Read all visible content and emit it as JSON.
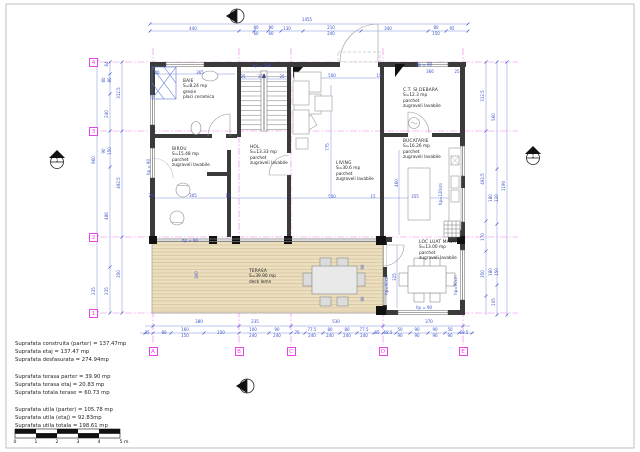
{
  "drawing": {
    "section_marks": {
      "left_label": "1",
      "right_label": "1"
    },
    "grid": {
      "cols": [
        {
          "t": "A",
          "x": 153
        },
        {
          "t": "B",
          "x": 239
        },
        {
          "t": "C",
          "x": 291
        },
        {
          "t": "D",
          "x": 383
        },
        {
          "t": "E",
          "x": 463
        }
      ],
      "rows": [
        {
          "t": "4",
          "y": 62
        },
        {
          "t": "3",
          "y": 131
        },
        {
          "t": "2",
          "y": 237
        },
        {
          "t": "1",
          "y": 313
        }
      ]
    },
    "rooms": [
      {
        "id": "baie",
        "x": 183,
        "y": 79,
        "lines": [
          "BAIE",
          "S=8.24 mp",
          "gresie",
          "placi ceramica"
        ]
      },
      {
        "id": "birou",
        "x": 172,
        "y": 147,
        "lines": [
          "BIROU",
          "S=15.48 mp",
          "parchet",
          "zugraveli lavabile"
        ]
      },
      {
        "id": "hol",
        "x": 250,
        "y": 145,
        "lines": [
          "HOL",
          "S=13.33 mp",
          "parchet",
          "zugraveli lavabile"
        ]
      },
      {
        "id": "living",
        "x": 336,
        "y": 161,
        "lines": [
          "LIVING",
          "S=30.6 mp",
          "parchet",
          "zugraveli lavabile"
        ]
      },
      {
        "id": "ct-debara",
        "x": 403,
        "y": 88,
        "lines": [
          "C.T. SI DEBARA",
          "S=12.3 mp",
          "parchet",
          "zugraveli lavabile"
        ]
      },
      {
        "id": "bucatarie",
        "x": 403,
        "y": 139,
        "lines": [
          "BUCATARIE",
          "S=16.26 mp",
          "parchet",
          "zugraveli lavabile"
        ]
      },
      {
        "id": "loc-luat-masa",
        "x": 419,
        "y": 240,
        "lines": [
          "LOC LUAT MASA",
          "S=13.00 mp",
          "parchet",
          "zugraveli lavabile"
        ]
      },
      {
        "id": "terasa",
        "x": 249,
        "y": 269,
        "lines": [
          "TERASA",
          "S=39.90 mp",
          "deck lemn"
        ]
      }
    ],
    "hp_labels": [
      {
        "t": "hp = 180",
        "x": 262,
        "y": 66
      },
      {
        "t": "hp = 90",
        "x": 424,
        "y": 65
      },
      {
        "t": "hp = 90",
        "x": 190,
        "y": 241
      },
      {
        "t": "hp = 90",
        "x": 424,
        "y": 308
      },
      {
        "t": "hp = 90",
        "x": 149,
        "y": 167,
        "v": true
      },
      {
        "t": "hp=120cm",
        "x": 441,
        "y": 194,
        "v": true
      },
      {
        "t": "hp=90cm",
        "x": 387,
        "y": 285,
        "v": true
      },
      {
        "t": "hp=90cm",
        "x": 456,
        "y": 285,
        "v": true
      }
    ],
    "dims": [
      {
        "t": "1455",
        "x": 307,
        "y": 20
      },
      {
        "t": "440",
        "x": 193,
        "y": 29
      },
      {
        "t": "80",
        "x": 256,
        "y": 27.5
      },
      {
        "t": "60",
        "x": 256,
        "y": 33.5
      },
      {
        "t": "80",
        "x": 271,
        "y": 27.5
      },
      {
        "t": "60",
        "x": 271,
        "y": 33.5
      },
      {
        "t": "130",
        "x": 287,
        "y": 29
      },
      {
        "t": "210",
        "x": 331,
        "y": 27.5
      },
      {
        "t": "240",
        "x": 331,
        "y": 33.5
      },
      {
        "t": "340",
        "x": 388,
        "y": 29
      },
      {
        "t": "80",
        "x": 436,
        "y": 27.5
      },
      {
        "t": "150",
        "x": 436,
        "y": 33.5
      },
      {
        "t": "95",
        "x": 452,
        "y": 29
      },
      {
        "t": "380",
        "x": 199,
        "y": 322
      },
      {
        "t": "235",
        "x": 255,
        "y": 322
      },
      {
        "t": "530",
        "x": 336,
        "y": 322
      },
      {
        "t": "370",
        "x": 429,
        "y": 322
      },
      {
        "t": "35",
        "x": 147,
        "y": 333
      },
      {
        "t": "80",
        "x": 164,
        "y": 333
      },
      {
        "t": "160",
        "x": 185,
        "y": 330
      },
      {
        "t": "150",
        "x": 185,
        "y": 335.5
      },
      {
        "t": "150",
        "x": 221,
        "y": 333
      },
      {
        "t": "100",
        "x": 253,
        "y": 330
      },
      {
        "t": "240",
        "x": 253,
        "y": 335.5
      },
      {
        "t": "90",
        "x": 277,
        "y": 330
      },
      {
        "t": "240",
        "x": 277,
        "y": 335.5
      },
      {
        "t": "70",
        "x": 297,
        "y": 333
      },
      {
        "t": "77.5",
        "x": 312,
        "y": 330
      },
      {
        "t": "240",
        "x": 312,
        "y": 335.5
      },
      {
        "t": "80",
        "x": 330,
        "y": 330
      },
      {
        "t": "240",
        "x": 330,
        "y": 335.5
      },
      {
        "t": "80",
        "x": 347,
        "y": 330
      },
      {
        "t": "240",
        "x": 347,
        "y": 335.5
      },
      {
        "t": "77.5",
        "x": 364,
        "y": 330
      },
      {
        "t": "240",
        "x": 364,
        "y": 335.5
      },
      {
        "t": "35",
        "x": 377,
        "y": 333
      },
      {
        "t": "68.5",
        "x": 388,
        "y": 333
      },
      {
        "t": "50",
        "x": 400,
        "y": 330
      },
      {
        "t": "90",
        "x": 400,
        "y": 335.5
      },
      {
        "t": "90",
        "x": 417,
        "y": 330
      },
      {
        "t": "90",
        "x": 417,
        "y": 335.5
      },
      {
        "t": "90",
        "x": 435,
        "y": 330
      },
      {
        "t": "90",
        "x": 435,
        "y": 335.5
      },
      {
        "t": "50",
        "x": 450,
        "y": 330
      },
      {
        "t": "90",
        "x": 450,
        "y": 335.5
      },
      {
        "t": "68.5",
        "x": 464,
        "y": 333
      },
      {
        "t": "64",
        "x": 107,
        "y": 64,
        "v": true
      },
      {
        "t": "80",
        "x": 104,
        "y": 80,
        "v": true
      },
      {
        "t": "80",
        "x": 109.5,
        "y": 80,
        "v": true
      },
      {
        "t": "312.5",
        "x": 119,
        "y": 93,
        "v": true
      },
      {
        "t": "240",
        "x": 107,
        "y": 114,
        "v": true
      },
      {
        "t": "960",
        "x": 94,
        "y": 160,
        "v": true
      },
      {
        "t": "90",
        "x": 104,
        "y": 151,
        "v": true
      },
      {
        "t": "150",
        "x": 109.5,
        "y": 151,
        "v": true
      },
      {
        "t": "492.5",
        "x": 119,
        "y": 183,
        "v": true
      },
      {
        "t": "486",
        "x": 107,
        "y": 216,
        "v": true
      },
      {
        "t": "235",
        "x": 94,
        "y": 291,
        "v": true
      },
      {
        "t": "235",
        "x": 107,
        "y": 291,
        "v": true
      },
      {
        "t": "350",
        "x": 119,
        "y": 274,
        "v": true
      },
      {
        "t": "312.5",
        "x": 483,
        "y": 96,
        "v": true
      },
      {
        "t": "560",
        "x": 494,
        "y": 117,
        "v": true
      },
      {
        "t": "1190",
        "x": 504,
        "y": 186,
        "v": true
      },
      {
        "t": "492.5",
        "x": 483,
        "y": 179,
        "v": true
      },
      {
        "t": "180",
        "x": 491,
        "y": 198,
        "v": true
      },
      {
        "t": "120",
        "x": 496.5,
        "y": 198,
        "v": true
      },
      {
        "t": "170",
        "x": 483,
        "y": 237,
        "v": true
      },
      {
        "t": "350",
        "x": 483,
        "y": 274,
        "v": true
      },
      {
        "t": "180",
        "x": 491,
        "y": 272,
        "v": true
      },
      {
        "t": "150",
        "x": 496.5,
        "y": 272,
        "v": true
      },
      {
        "t": "105",
        "x": 494,
        "y": 302,
        "v": true
      },
      {
        "t": "20",
        "x": 157,
        "y": 73
      },
      {
        "t": "365",
        "x": 200,
        "y": 73
      },
      {
        "t": "25",
        "x": 243,
        "y": 77
      },
      {
        "t": "210",
        "x": 262,
        "y": 77
      },
      {
        "t": "25",
        "x": 282,
        "y": 77
      },
      {
        "t": "500",
        "x": 332,
        "y": 76
      },
      {
        "t": "15",
        "x": 379,
        "y": 76
      },
      {
        "t": "366",
        "x": 430,
        "y": 72
      },
      {
        "t": "25",
        "x": 457,
        "y": 72
      },
      {
        "t": "775",
        "x": 328,
        "y": 147,
        "v": true
      },
      {
        "t": "20",
        "x": 151,
        "y": 196
      },
      {
        "t": "305",
        "x": 193,
        "y": 196
      },
      {
        "t": "15",
        "x": 228,
        "y": 196
      },
      {
        "t": "500",
        "x": 332,
        "y": 197
      },
      {
        "t": "15",
        "x": 373,
        "y": 197
      },
      {
        "t": "355",
        "x": 415,
        "y": 197
      },
      {
        "t": "460",
        "x": 397,
        "y": 183,
        "v": true
      },
      {
        "t": "300",
        "x": 197,
        "y": 275,
        "v": true
      },
      {
        "t": "90",
        "x": 363,
        "y": 267,
        "v": true
      },
      {
        "t": "90",
        "x": 363,
        "y": 299,
        "v": true
      },
      {
        "t": "325",
        "x": 395,
        "y": 277,
        "v": true
      }
    ],
    "summary_lines": [
      "Suprafata construita (parter)  = 137.47mp",
      "Suprafata etaj  = 137.47 mp",
      "Suprafata desfasurata  = 274.94mp",
      "",
      "Suprafata terasa parter  = 39.90 mp",
      "Suprafata terasa etaj  = 20.83 mp",
      "Suprafata totala terase  = 60.73 mp",
      "",
      "Suprafata utila (parter)  = 105.78 mp",
      "Suprafata utila (etaj)  = 92.83mp",
      "Suprafata utila totala  = 198.61 mp"
    ],
    "scale_bar": {
      "labels": [
        "0",
        "1",
        "2",
        "3",
        "4",
        "5 m"
      ]
    }
  },
  "colors": {
    "dimension_blue": "#3b52c8",
    "grid_magenta": "#e845e8",
    "wall_dark": "#3a3a3a",
    "deck_fill": "#ecdfc0",
    "deck_line": "#c9b38a"
  }
}
